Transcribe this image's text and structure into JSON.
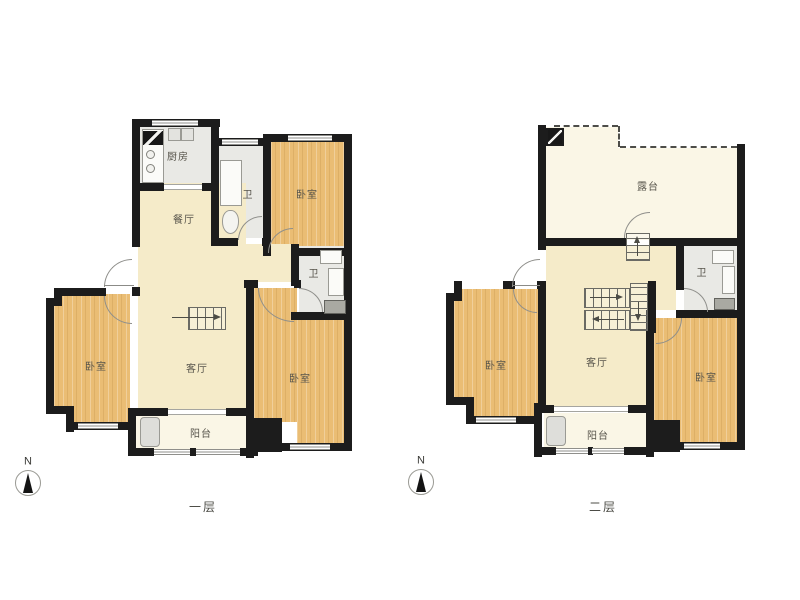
{
  "colors": {
    "wall": "#1c1c1c",
    "bedroom_floor": "#eabd74",
    "living_floor": "#f5ebc9",
    "balcony_floor": "#faf6e6",
    "bath_floor": "#e9e9e5",
    "door_line": "#8f8f8b",
    "label_text": "#57544b"
  },
  "floor1": {
    "caption": "一层",
    "compass_label": "N",
    "rooms": {
      "kitchen": "厨房",
      "dining": "餐厅",
      "bath_top": "卫",
      "bedroom_top": "卧室",
      "bath_mid": "卫",
      "living": "客厅",
      "bedroom_left": "卧室",
      "bedroom_bottom": "卧室",
      "balcony": "阳台"
    }
  },
  "floor2": {
    "caption": "二层",
    "compass_label": "N",
    "rooms": {
      "terrace": "露台",
      "bath": "卫",
      "living": "客厅",
      "bedroom_left": "卧室",
      "bedroom_right": "卧室",
      "balcony": "阳台"
    }
  }
}
